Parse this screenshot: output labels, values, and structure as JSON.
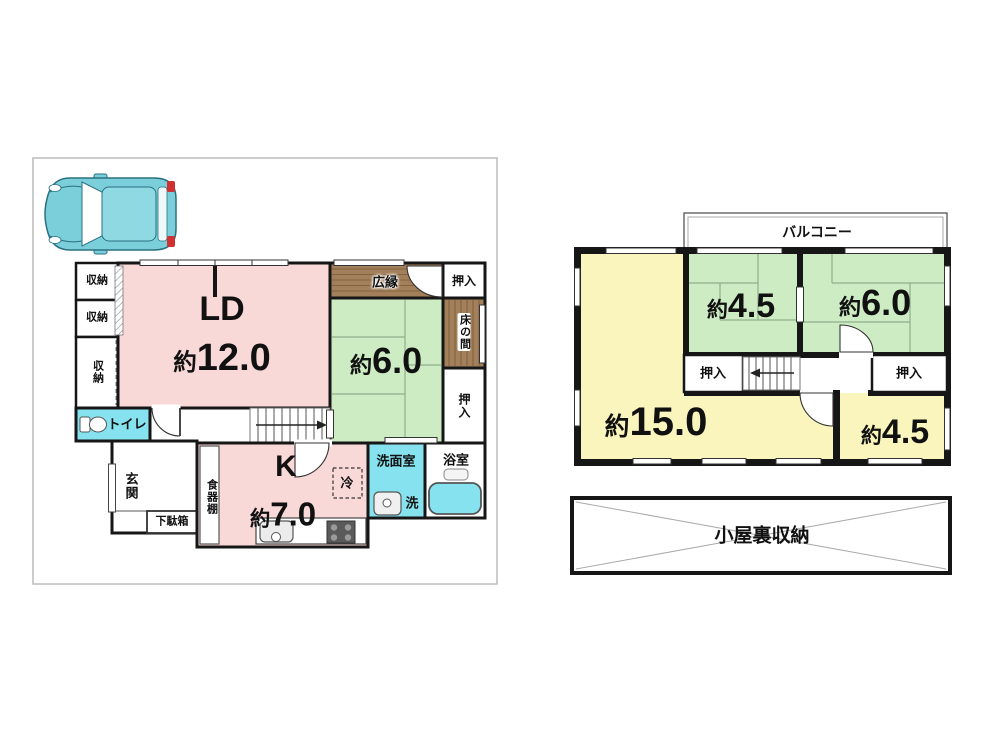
{
  "floor1": {
    "ld_label": "LD",
    "k_label": "K",
    "shuno": "収納",
    "oshiire": "押入",
    "hiroen": "広縁",
    "tokonoma": "床の間",
    "toilet": "トイレ",
    "genkan": "玄関",
    "getabako": "下駄箱",
    "shokkidana": "食器棚",
    "senmen": "洗面室",
    "bath": "浴室",
    "laundry": "洗",
    "fridge": "冷",
    "sizes": {
      "ld": {
        "p": "約",
        "v": "12.0"
      },
      "washitsu": {
        "p": "約",
        "v": "6.0"
      },
      "k": {
        "p": "約",
        "v": "7.0"
      }
    }
  },
  "floor2": {
    "balcony": "バルコニー",
    "oshiire": "押入",
    "attic": "小屋裏収納",
    "sizes": {
      "r15": {
        "p": "約",
        "v": "15.0"
      },
      "r45a": {
        "p": "約",
        "v": "4.5"
      },
      "r60": {
        "p": "約",
        "v": "6.0"
      },
      "r45b": {
        "p": "約",
        "v": "4.5"
      }
    }
  },
  "colors": {
    "pink": "#f8d9d8",
    "green": "#cdecc4",
    "yellow": "#f9f5bd",
    "cyan": "#85e2ee",
    "wood": "#a3805b",
    "woodline": "#82643f",
    "wall": "#161616",
    "carbody": "#7bcfdb"
  }
}
